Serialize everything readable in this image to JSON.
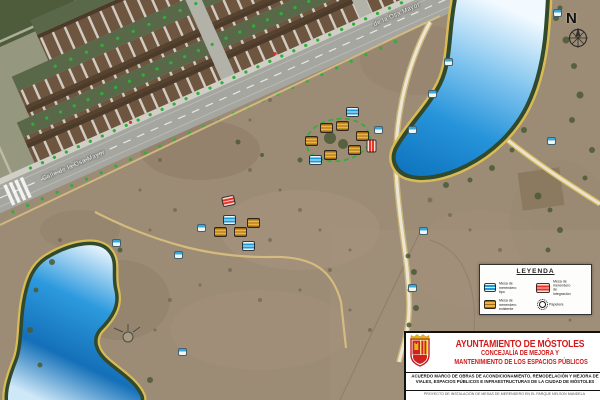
{
  "map": {
    "street_label_main": "Calle de la Osa Mayor",
    "street_label_secondary": "de la Osa Mayor",
    "north_label": "N",
    "marker_colors": {
      "yellow": "#eeb243",
      "blue": "#1f9ad8",
      "red": "#e6362a",
      "bench": "#35aade"
    },
    "route_color": "#2fae3c",
    "lake_color": "#1b86d2",
    "markers": [
      {
        "x": 352,
        "y": 112,
        "type": "blue"
      },
      {
        "x": 315,
        "y": 160,
        "type": "blue"
      },
      {
        "x": 326,
        "y": 128,
        "type": "yellow"
      },
      {
        "x": 342,
        "y": 126,
        "type": "yellow"
      },
      {
        "x": 311,
        "y": 141,
        "type": "yellow"
      },
      {
        "x": 330,
        "y": 155,
        "type": "yellow"
      },
      {
        "x": 354,
        "y": 150,
        "type": "yellow"
      },
      {
        "x": 362,
        "y": 136,
        "type": "yellow"
      },
      {
        "x": 371,
        "y": 146,
        "type": "red",
        "rot": 90
      },
      {
        "x": 378,
        "y": 130,
        "type": "cyan"
      },
      {
        "x": 228,
        "y": 201,
        "type": "red",
        "rot": -12
      },
      {
        "x": 229,
        "y": 220,
        "type": "blue"
      },
      {
        "x": 248,
        "y": 246,
        "type": "blue"
      },
      {
        "x": 220,
        "y": 232,
        "type": "yellow"
      },
      {
        "x": 240,
        "y": 232,
        "type": "yellow"
      },
      {
        "x": 253,
        "y": 223,
        "type": "yellow"
      },
      {
        "x": 201,
        "y": 228,
        "type": "cyan"
      },
      {
        "x": 448,
        "y": 62,
        "type": "cyan"
      },
      {
        "x": 432,
        "y": 94,
        "type": "cyan"
      },
      {
        "x": 412,
        "y": 130,
        "type": "cyan"
      },
      {
        "x": 551,
        "y": 141,
        "type": "cyan"
      },
      {
        "x": 557,
        "y": 13,
        "type": "cyan"
      },
      {
        "x": 423,
        "y": 231,
        "type": "cyan"
      },
      {
        "x": 412,
        "y": 288,
        "type": "cyan"
      },
      {
        "x": 116,
        "y": 243,
        "type": "cyan"
      },
      {
        "x": 178,
        "y": 255,
        "type": "cyan"
      },
      {
        "x": 182,
        "y": 352,
        "type": "cyan"
      }
    ]
  },
  "legend": {
    "title": "LEYENDA",
    "items": [
      {
        "label": "Mesa de merendero tipo"
      },
      {
        "label": "Mesa de merendero existente"
      },
      {
        "label": "Mesa de merendero de integración"
      },
      {
        "label": "Papelera"
      }
    ]
  },
  "title_block": {
    "org": "AYUNTAMIENTO DE MÓSTOLES",
    "dept_line1": "CONCEJALÍA DE  MEJORA Y",
    "dept_line2": "MANTENIMIENTO DE  LOS ESPACIOS PÚBLICOS",
    "framework_line1": "ACUERDO MARCO DE OBRAS DE ACONDICIONAMIENTO, REMODELACIÓN Y MEJORA DE",
    "framework_line2": "VIALES, ESPACIOS PÚBLICOS E INFRAESTRUCTURAS DE LA CIUDAD DE MÓSTOLES",
    "project": "PROYECTO DE INSTALACIÓN DE MESAS DE MERENDERO EN EL PARQUE NELSON MANDELA",
    "accent_color": "#d11a1a"
  }
}
